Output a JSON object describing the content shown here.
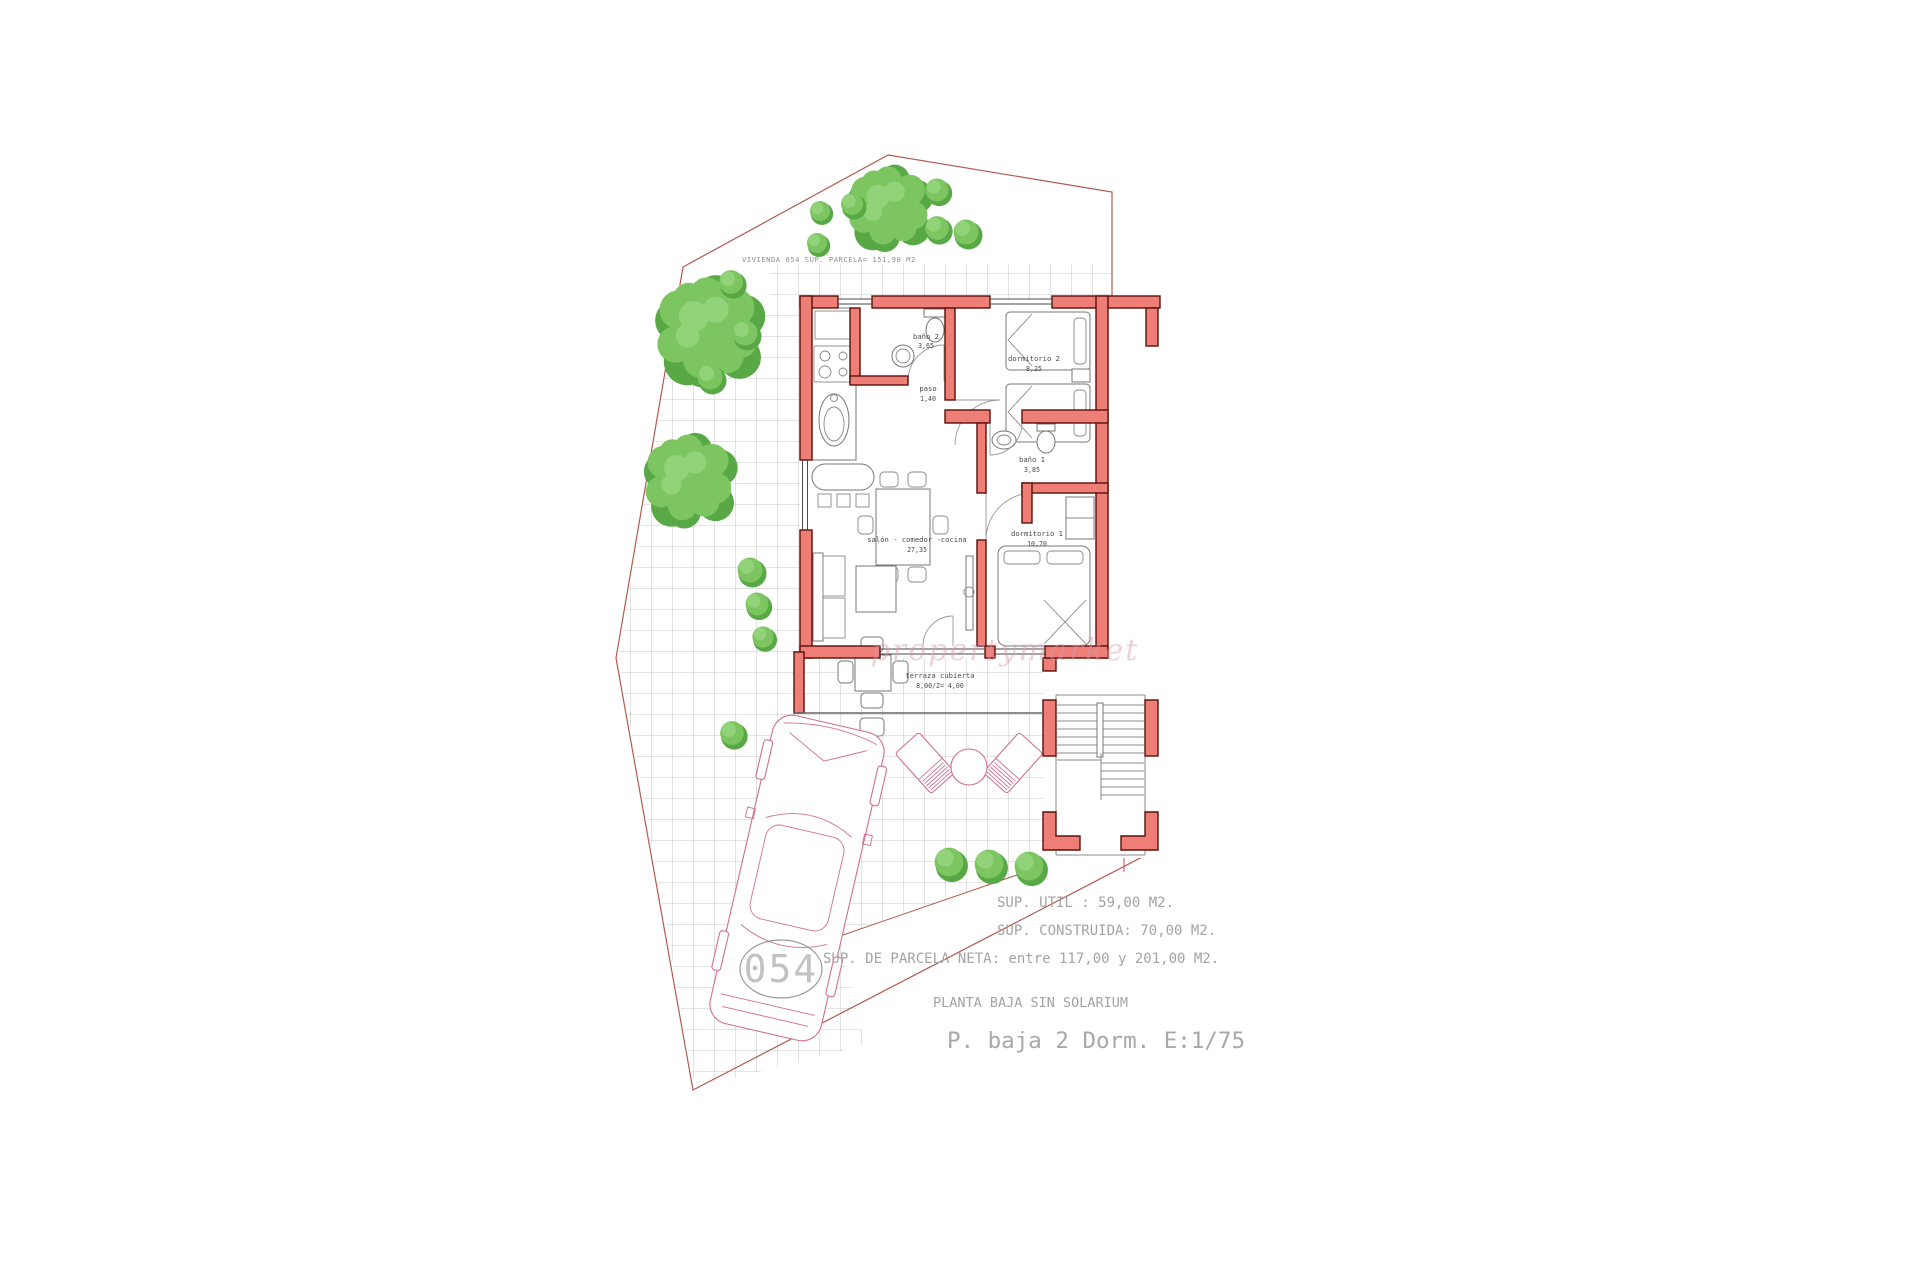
{
  "plan": {
    "parcel_label": "VIVIENDA 054 SUP. PARCELA= 151,90 M2",
    "unit_number": "054",
    "rooms": [
      {
        "name": "baño 2",
        "area": "3,65"
      },
      {
        "name": "paso",
        "area": "1,40"
      },
      {
        "name": "dormitorio 2",
        "area": "8,25"
      },
      {
        "name": "baño 1",
        "area": "3,85"
      },
      {
        "name": "dormitorio 1",
        "area": "10,70"
      },
      {
        "name": "salón - comedor -cocina",
        "area": "27,35"
      },
      {
        "name": "terraza cubierta",
        "area": "8,00/2= 4,00"
      }
    ],
    "summary_lines": [
      "SUP. UTIL : 59,00 M2.",
      "SUP. CONSTRUIDA: 70,00 M2.",
      "SUP. DE PARCELA NETA: entre 117,00 y 201,00 M2.",
      "PLANTA BAJA SIN SOLARIUM"
    ],
    "scale_title": "P. baja 2 Dorm. E:1/75",
    "watermark": "propertymarket",
    "colors": {
      "wall_fill": "#ee7e76",
      "wall_outline": "#5a100b",
      "tree_green": "#7cc561",
      "tree_shadow": "#58a845",
      "boundary_red": "#b05a50",
      "annotation_gray": "#a3a3a3",
      "furniture_pink": "#d06f92"
    }
  }
}
